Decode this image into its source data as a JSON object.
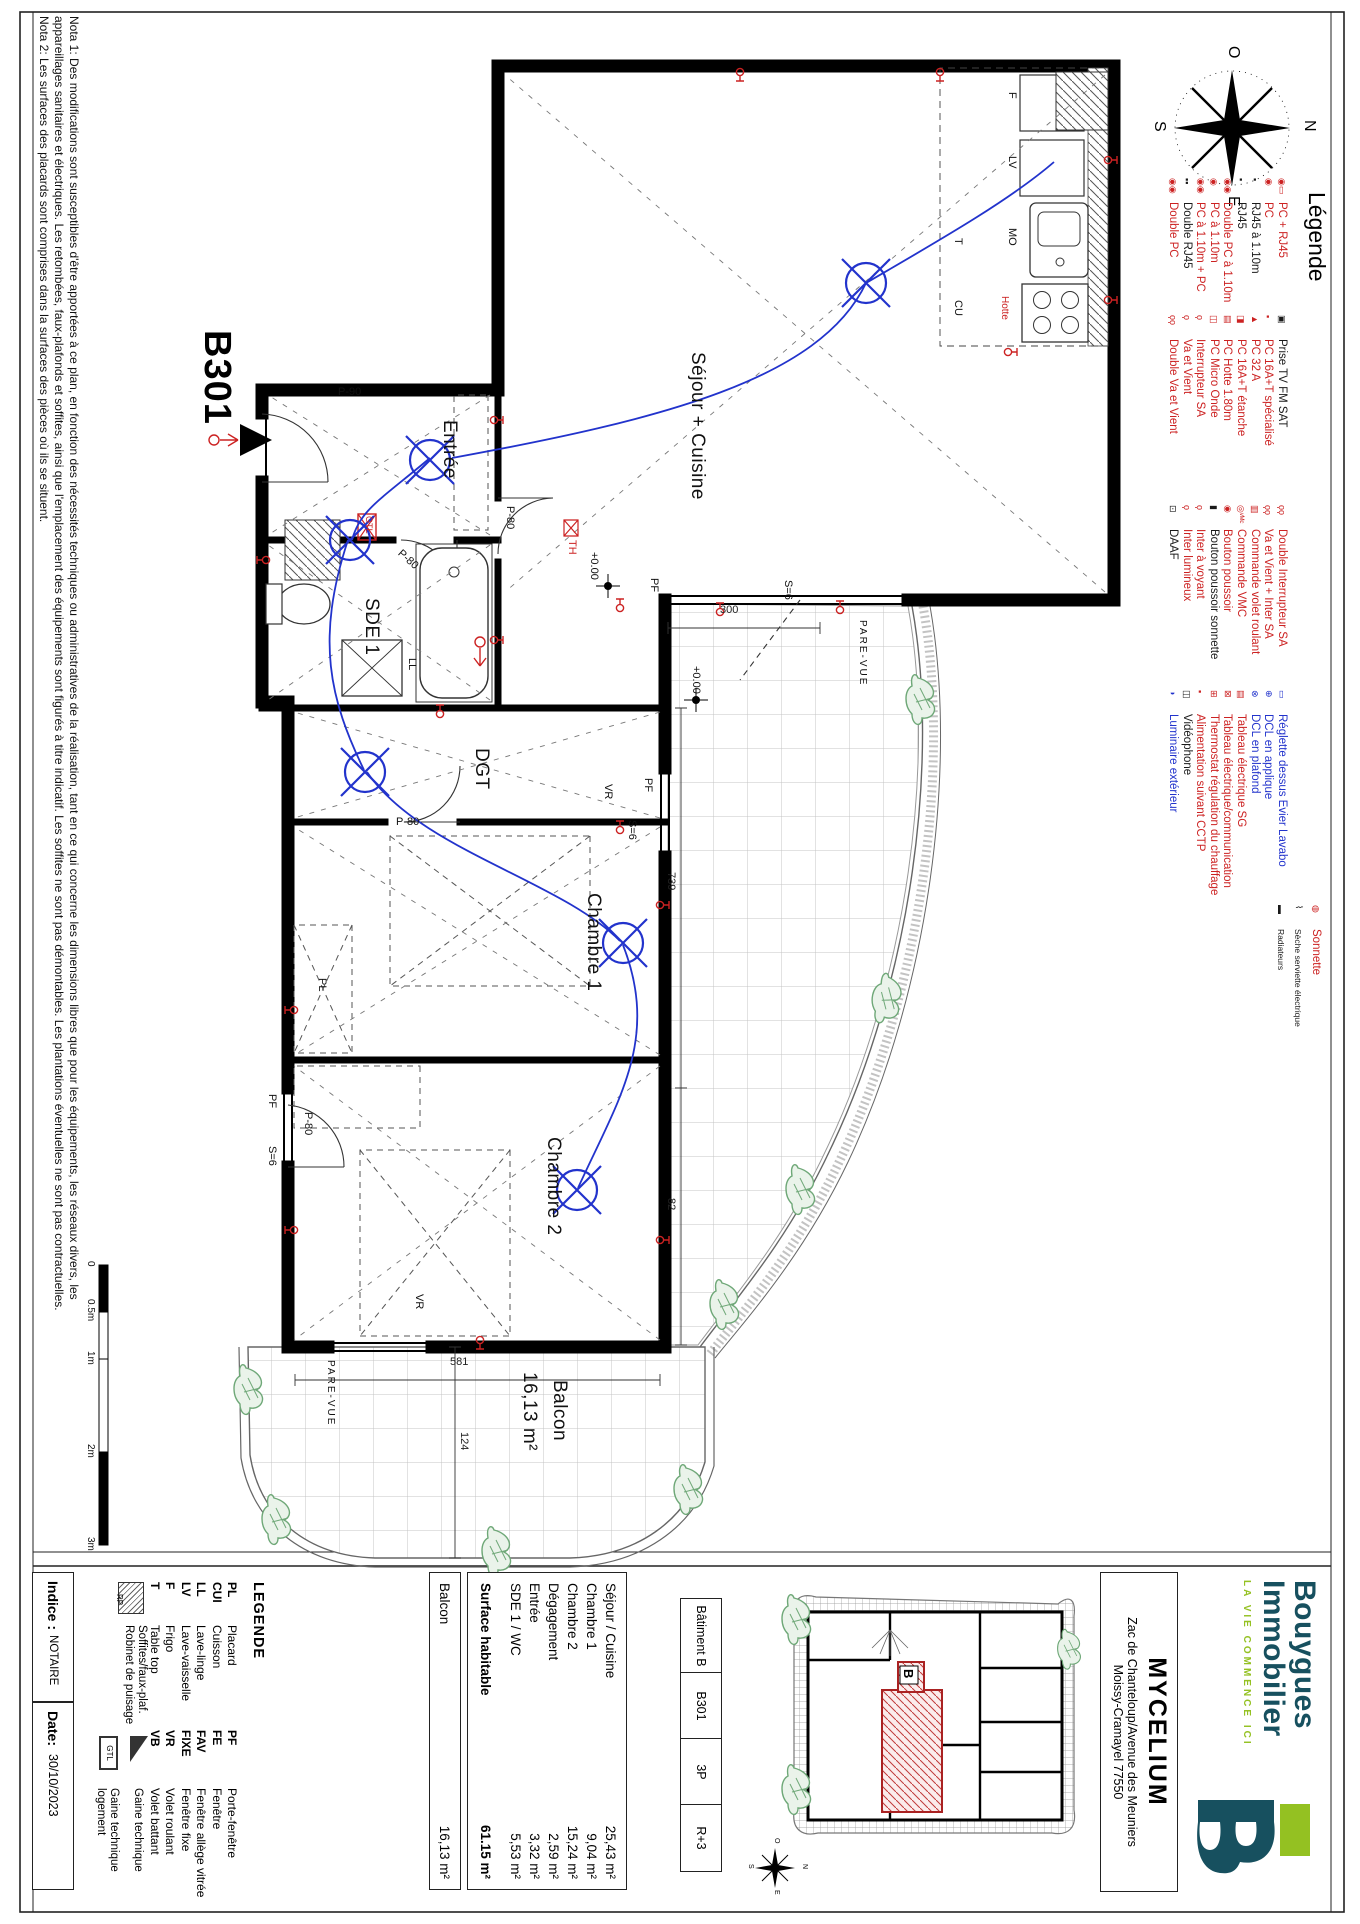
{
  "colors": {
    "red": "#cc2222",
    "blue": "#2233cc",
    "black": "#1a1a1a",
    "teal": "#17505f",
    "green": "#94c122",
    "plant": "#6fa878"
  },
  "notes": {
    "line1": "Nota 1: Des modifications sont susceptibles d'être apportées à ce plan, en fonction des nécessités techniques ou administratives de la réalisation, tant en ce qui concerne les dimensions libres que pour les équipements, les réseaux divers, les",
    "line2": "appareillages sanitaires et électriques. Les retombées, faux-plafonds et soffites, ainsi que l'emplacement des équipements sont figurés à titre indicatif. Les soffites ne sont pas démontables. Les plantations éventuelles ne sont pas contractuelles.",
    "line3": "Nota 2: Les surfaces des placards sont comprises dans la surfaces des pièces où ils se situent."
  },
  "compass": {
    "n": "N",
    "e": "E",
    "s": "S",
    "o": "O"
  },
  "scalebar": {
    "labels": [
      "0",
      "0.5m",
      "1m",
      "2m",
      "3m"
    ]
  },
  "plan": {
    "unit": "B301",
    "rooms": {
      "sejour": "Séjour + Cuisine",
      "entree": "Entrée",
      "sde": "SDE 1",
      "dgt": "DGT",
      "ch1": "Chambre 1",
      "ch2": "Chambre 2",
      "balcon": "Balcon",
      "balcon_area": "16,13 m²"
    },
    "dims": {
      "d300": "300",
      "d739": "739",
      "d82": "82",
      "d581": "581",
      "d124": "124"
    },
    "doors": {
      "p90": "P-90",
      "p80": "P-80"
    },
    "win": {
      "pf": "PF",
      "s6": "S=6",
      "vr": "VR"
    },
    "levels": "+0.00",
    "pare": "PARE-VUE",
    "th": "TH",
    "gtl": "GTL",
    "kitchen": {
      "mo": "MO",
      "hotte": "Hotte",
      "cu": "CU",
      "lv": "LV",
      "f": "F",
      "t": "T",
      "ll": "LL",
      "pl": "PL"
    }
  },
  "legend": {
    "title": "Légende",
    "col1": [
      {
        "sym": "◉▭",
        "c": "#cc2222",
        "label": "PC + RJ45"
      },
      {
        "sym": "◉",
        "c": "#cc2222",
        "label": "PC"
      },
      {
        "sym": "▪",
        "c": "#1a1a1a",
        "label": "RJ45 à 1.10m"
      },
      {
        "sym": "▪",
        "c": "#1a1a1a",
        "label": "RJ45"
      },
      {
        "sym": "◉◉",
        "c": "#cc2222",
        "label": "Double PC à 1.10m"
      },
      {
        "sym": "◉",
        "c": "#cc2222",
        "label": "PC à 1.10m"
      },
      {
        "sym": "◉◉",
        "c": "#cc2222",
        "label": "PC à 1.10m + PC"
      },
      {
        "sym": "▪▪",
        "c": "#1a1a1a",
        "label": "Double RJ45"
      },
      {
        "sym": "◉◉",
        "c": "#cc2222",
        "label": "Double PC"
      }
    ],
    "col2": [
      {
        "sym": "▣",
        "c": "#1a1a1a",
        "label": "Prise TV FM SAT"
      },
      {
        "sym": "▪",
        "c": "#cc2222",
        "label": "PC 16A+T spécialisé"
      },
      {
        "sym": "▲",
        "c": "#cc2222",
        "label": "PC 32 A"
      },
      {
        "sym": "◨",
        "c": "#cc2222",
        "label": "PC 16A+T étanche"
      },
      {
        "sym": "▤",
        "c": "#cc2222",
        "label": "PC Hotte 1.80m"
      },
      {
        "sym": "◫",
        "c": "#cc2222",
        "label": "PC Micro Onde"
      },
      {
        "sym": "ϙ",
        "c": "#cc2222",
        "label": "Interrupteur SA"
      },
      {
        "sym": "ϙ",
        "c": "#cc2222",
        "label": "Va et Vient"
      },
      {
        "sym": "ϙϙ",
        "c": "#cc2222",
        "label": "Double Va et Vient"
      }
    ],
    "col3": [
      {
        "sym": "ϙϙ",
        "c": "#cc2222",
        "label": "Double Interrupteur SA"
      },
      {
        "sym": "ϙϙ",
        "c": "#cc2222",
        "label": "Va et Vient + Inter SA"
      },
      {
        "sym": "▥",
        "c": "#cc2222",
        "label": "Commande volet roulant"
      },
      {
        "sym": "◎ᵛᴹᶜ",
        "c": "#cc2222",
        "label": "Commande VMC"
      },
      {
        "sym": "◉",
        "c": "#cc2222",
        "label": "Bouton poussoir"
      },
      {
        "sym": "▮",
        "c": "#1a1a1a",
        "label": "Bouton poussoir sonnette"
      },
      {
        "sym": "ϙ",
        "c": "#cc2222",
        "label": "Inter à voyant"
      },
      {
        "sym": "ϙ",
        "c": "#cc2222",
        "label": "Inter lumineux"
      },
      {
        "sym": "⊡",
        "c": "#1a1a1a",
        "label": "DAAF"
      }
    ],
    "col4": [
      {
        "sym": "▭",
        "c": "#2233cc",
        "label": "Réglette dessus Evier Lavabo"
      },
      {
        "sym": "⊕",
        "c": "#2233cc",
        "label": "DCL en applique"
      },
      {
        "sym": "⊗",
        "c": "#2233cc",
        "label": "DCL en plafond"
      },
      {
        "sym": "▤",
        "c": "#cc2222",
        "label": "Tableau électrique SG"
      },
      {
        "sym": "⊠",
        "c": "#cc2222",
        "label": "Tableau électrique/communication"
      },
      {
        "sym": "⊞",
        "c": "#cc2222",
        "label": "Thermostat régulation du chauffage"
      },
      {
        "sym": "▪",
        "c": "#cc2222",
        "label": "Alimentation suivant CCTP"
      },
      {
        "sym": "◫",
        "c": "#1a1a1a",
        "label": "Vidéophone"
      },
      {
        "sym": "◑",
        "c": "#2233cc",
        "label": "Luminaire extérieur"
      }
    ],
    "col5": [
      {
        "sym": "◍",
        "c": "#cc2222",
        "label": "Sonnette"
      },
      {
        "sym": "⌇",
        "c": "#1a1a1a",
        "label": "Sèche serviette électrique"
      },
      {
        "sym": "▬",
        "c": "#1a1a1a",
        "label": "Radiateurs"
      }
    ]
  },
  "titleblock": {
    "legende": {
      "title": "LEGENDE",
      "col1": [
        {
          "abbr": "PL",
          "label": "Placard"
        },
        {
          "abbr": "CUI",
          "label": "Cuisson"
        },
        {
          "abbr": "LL",
          "label": "Lave-linge"
        },
        {
          "abbr": "LV",
          "label": "Lave-vaisselle"
        },
        {
          "abbr": "F",
          "label": "Frigo"
        },
        {
          "abbr": "T",
          "label": "Table top"
        }
      ],
      "col2": [
        {
          "abbr": "PF",
          "label": "Porte-fenêtre"
        },
        {
          "abbr": "FE",
          "label": "Fenêtre"
        },
        {
          "abbr": "FAV",
          "label": "Fenêtre allège vitrée"
        },
        {
          "abbr": "FIXE",
          "label": "Fenêtre fixe"
        },
        {
          "abbr": "VR",
          "label": "Volet roulant"
        },
        {
          "abbr": "VB",
          "label": "Volet battant"
        }
      ],
      "soffites1": "Soffites/faux-plaf.",
      "soffites2": "Robinet de puisage",
      "rp": "RP",
      "gaine": "Gaine technique",
      "gaine2a": "Gaine technique",
      "gaine2b": "logement",
      "gtl": "GTL"
    },
    "areas": {
      "rows": [
        {
          "name": "Séjour / Cuisine",
          "value": "25,43 m²"
        },
        {
          "name": "Chambre 1",
          "value": "9,04 m²"
        },
        {
          "name": "Chambre 2",
          "value": "15,24 m²"
        },
        {
          "name": "Dégagement",
          "value": "2,59 m²"
        },
        {
          "name": "Entrée",
          "value": "3,32 m²"
        },
        {
          "name": "SDE 1 / WC",
          "value": "5,53 m²"
        }
      ],
      "total": {
        "name": "Surface habitable",
        "value": "61.15 m²"
      },
      "balcon": {
        "name": "Balcon",
        "value": "16,13 m²"
      }
    },
    "batiment": [
      "Bâtiment B",
      "B301",
      "3P",
      "R+3"
    ],
    "project": {
      "name": "MYCELIUM",
      "address1": "Zac de Chanteloup/Avenue des Meuniers",
      "address2": "Moissy-Cramayel 77550"
    },
    "brand": {
      "name1": "Bouygues",
      "name2": "Immobilier",
      "tagline": "LA VIE COMMENCE ICI",
      "mark": "B"
    },
    "keyplan": {
      "b": "B"
    },
    "indice": {
      "label": "Indice :",
      "value": "NOTAIRE",
      "date_label": "Date:",
      "date": "30/10/2023"
    }
  }
}
